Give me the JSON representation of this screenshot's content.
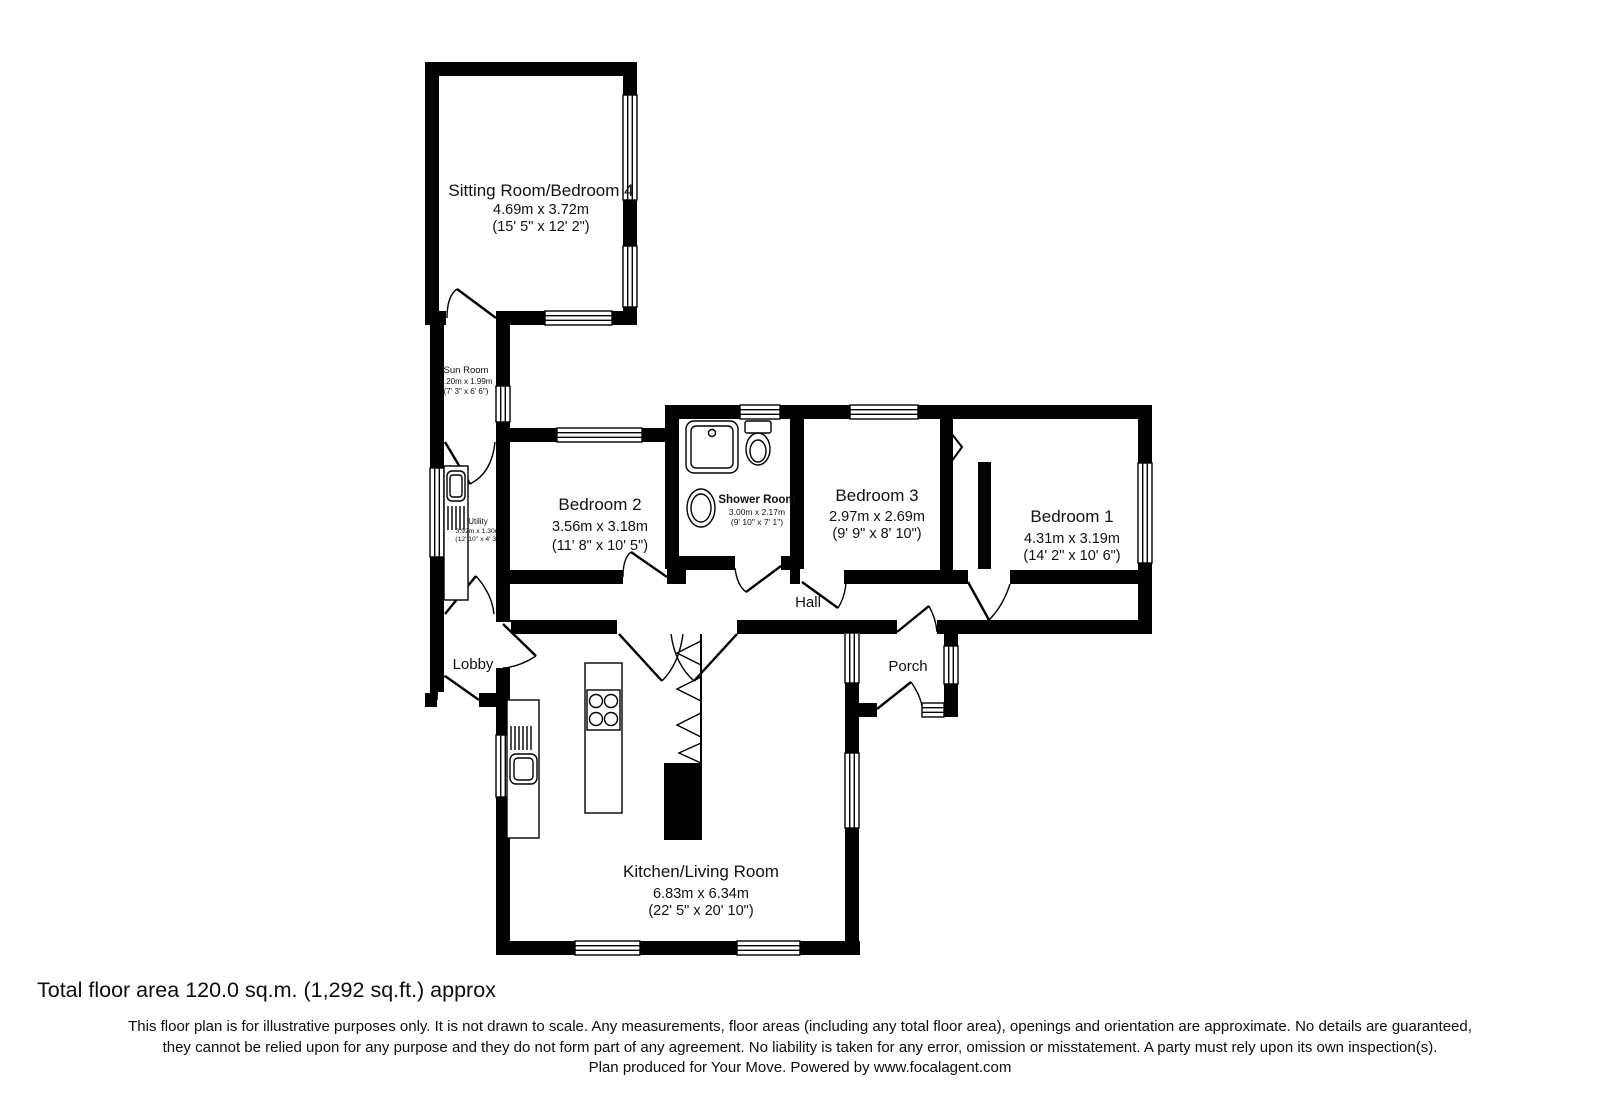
{
  "rooms": {
    "sitting": {
      "name": "Sitting Room/Bedroom 4",
      "metric": "4.69m x 3.72m",
      "imperial": "(15' 5\" x 12' 2\")"
    },
    "sun": {
      "name": "Sun Room",
      "metric": "2.20m x 1.99m",
      "imperial": "(7' 3\" x 6' 6\")"
    },
    "utility": {
      "name": "Utility",
      "metric": "3.92m x 1.30m",
      "imperial": "(12' 10\" x 4' 3\")"
    },
    "bedroom2": {
      "name": "Bedroom 2",
      "metric": "3.56m x 3.18m",
      "imperial": "(11' 8\" x 10' 5\")"
    },
    "shower": {
      "name": "Shower Room",
      "metric": "3.00m x 2.17m",
      "imperial": "(9' 10\" x 7' 1\")"
    },
    "bedroom3": {
      "name": "Bedroom 3",
      "metric": "2.97m x 2.69m",
      "imperial": "(9' 9\" x 8' 10\")"
    },
    "bedroom1": {
      "name": "Bedroom 1",
      "metric": "4.31m x 3.19m",
      "imperial": "(14' 2\" x 10' 6\")"
    },
    "hall": {
      "name": "Hall"
    },
    "lobby": {
      "name": "Lobby"
    },
    "porch": {
      "name": "Porch"
    },
    "kitchen": {
      "name": "Kitchen/Living Room",
      "metric": "6.83m x 6.34m",
      "imperial": "(22' 5\" x 20' 10\")"
    }
  },
  "footer": {
    "total_area": "Total floor area 120.0 sq.m. (1,292 sq.ft.) approx",
    "disclaimer_line1": "This floor plan is for illustrative purposes only. It is not drawn to scale. Any measurements, floor areas (including any total floor area), openings and orientation are approximate. No details are guaranteed,",
    "disclaimer_line2": "they cannot be relied upon for any purpose and they do not form part of any agreement. No liability is taken for any error, omission or misstatement. A party must rely upon its own inspection(s).",
    "disclaimer_line3": "Plan produced for Your Move. Powered by www.focalagent.com"
  },
  "colors": {
    "wall": "#000000",
    "text": "#111111",
    "background": "#ffffff"
  }
}
